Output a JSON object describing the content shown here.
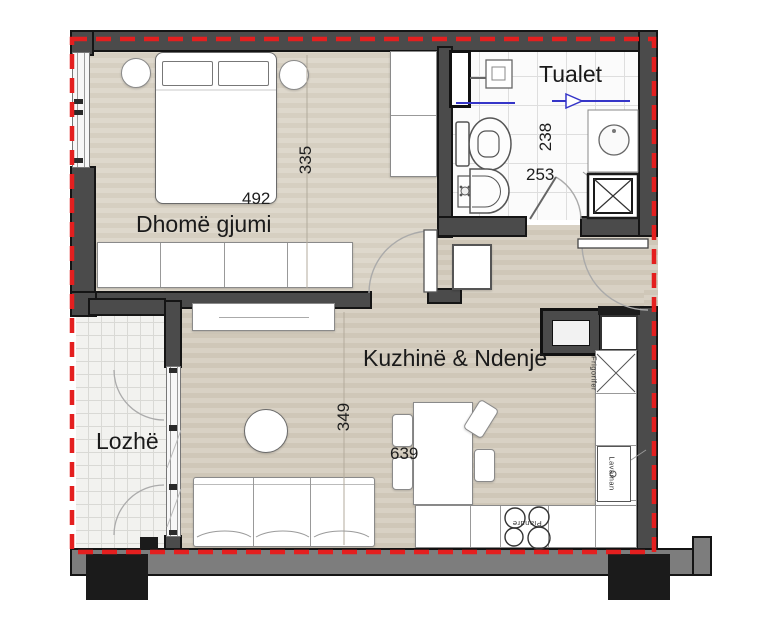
{
  "plan": {
    "rooms": {
      "bedroom": {
        "label": "Dhomë gjumi",
        "width_cm": "492",
        "height_cm": "335"
      },
      "toilet": {
        "label": "Tualet",
        "width_cm": "253",
        "height_cm": "238"
      },
      "kitchen_living": {
        "label": "Kuzhinë & Ndenje",
        "width_cm": "639",
        "height_cm": "349"
      },
      "loggia": {
        "label": "Lozhë"
      }
    },
    "appliances": {
      "fridge": "Frigorifer",
      "sink": "Lavaman",
      "cooktop": "Pianure"
    },
    "style": {
      "boundary_color": "#e41f1f",
      "wall_color": "#4b4b4b",
      "plumbing_color": "#3535c8"
    }
  }
}
